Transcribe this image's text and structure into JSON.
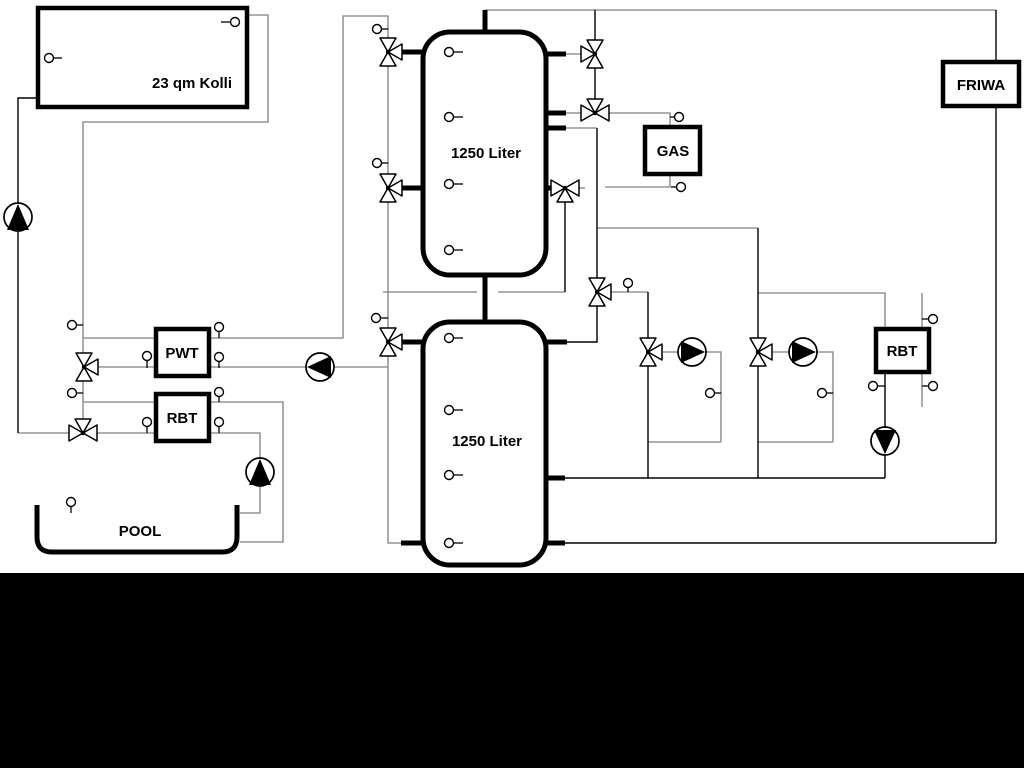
{
  "labels": {
    "collector": "23 qm Kolli",
    "upper_tank": "1250 Liter",
    "lower_tank": "1250 Liter",
    "gas": "GAS",
    "friwa": "FRIWA",
    "pwt": "PWT",
    "rbt_left": "RBT",
    "rbt_right": "RBT",
    "pool": "POOL"
  },
  "colors": {
    "background": "#ffffff",
    "pipe_gray": "#808080",
    "pipe_black": "#000000",
    "component_stroke": "#000000",
    "bottom_band": "#000000"
  },
  "icons": {
    "pumps": [
      {
        "name": "solar-return-pump",
        "direction": "up"
      },
      {
        "name": "pwt-pump",
        "direction": "left"
      },
      {
        "name": "pool-pump",
        "direction": "up"
      },
      {
        "name": "heating-circuit-1-pump",
        "direction": "right"
      },
      {
        "name": "heating-circuit-2-pump",
        "direction": "right"
      },
      {
        "name": "rbt-right-pump",
        "direction": "down"
      }
    ],
    "three_way_valve_count": 11,
    "temperature_sensor_count": 30
  }
}
